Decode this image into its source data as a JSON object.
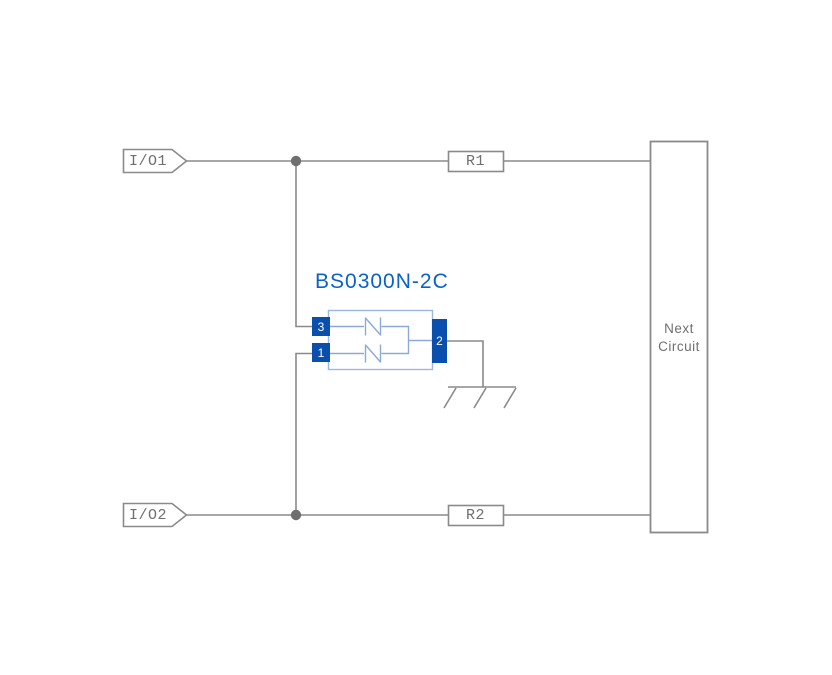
{
  "diagram": {
    "title": "BS0300N-2C",
    "ports": [
      {
        "label": "I/O1"
      },
      {
        "label": "I/O2"
      }
    ],
    "resistors": [
      {
        "label": "R1"
      },
      {
        "label": "R2"
      }
    ],
    "next_circuit": {
      "label": "Next Circuit"
    },
    "component": {
      "name": "BS0300N-2C",
      "pins": [
        {
          "number": "3"
        },
        {
          "number": "1"
        },
        {
          "number": "2"
        }
      ],
      "internal_elements": [
        "bidirectional-tvs-diode",
        "bidirectional-tvs-diode"
      ]
    },
    "ground": {
      "type": "chassis-ground"
    },
    "colors": {
      "wire_gray": "#8a8a8a",
      "junction_dot": "#6f6f6f",
      "label_text": "#6f6f6f",
      "pin_blue": "#0b4fae",
      "title_blue": "#0a62c9",
      "component_outline_blue": "#9db8de",
      "component_line_blue": "#8caad4",
      "background": "#ffffff"
    }
  }
}
